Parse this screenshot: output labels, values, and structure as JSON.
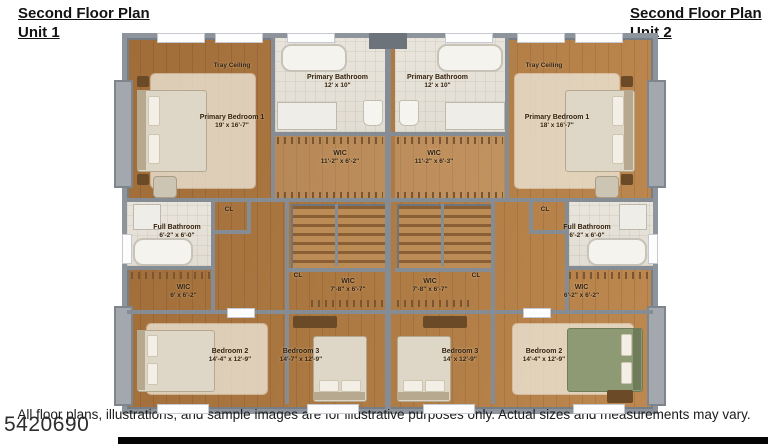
{
  "header": {
    "unit1": {
      "line1": "Second Floor Plan",
      "line2": "Unit 1"
    },
    "unit2": {
      "line1": "Second Floor Plan",
      "line2": "Unit 2"
    }
  },
  "plan": {
    "unit1": {
      "tray_ceiling": "Tray Ceiling",
      "primary_bedroom": {
        "name": "Primary Bedroom 1",
        "dims": "19' x 16'-7\""
      },
      "primary_bathroom": {
        "name": "Primary Bathroom",
        "dims": "12' x 10\""
      },
      "wic_upper": {
        "name": "WIC",
        "dims": "11'-2\" x 6'-2\""
      },
      "cl_upper": "CL",
      "full_bathroom": {
        "name": "Full Bathroom",
        "dims": "6'-2\" x 6'-0\""
      },
      "wic_side": {
        "name": "WIC",
        "dims": "6' x 6'-2\""
      },
      "cl_hall": "CL",
      "wic_hall": {
        "name": "WIC",
        "dims": "7'-8\" x 6'-7\""
      },
      "bedroom2": {
        "name": "Bedroom 2",
        "dims": "14'-4\" x 12'-9\""
      },
      "bedroom3": {
        "name": "Bedroom 3",
        "dims": "14'-7\" x 12'-9\""
      }
    },
    "unit2": {
      "tray_ceiling": "Tray Ceiling",
      "primary_bedroom": {
        "name": "Primary Bedroom 1",
        "dims": "18' x 16'-7\""
      },
      "primary_bathroom": {
        "name": "Primary Bathroom",
        "dims": "12' x 10\""
      },
      "wic_upper": {
        "name": "WIC",
        "dims": "11'-2\" x 6'-3\""
      },
      "cl_upper": "CL",
      "full_bathroom": {
        "name": "Full Bathroom",
        "dims": "6'-2\" x 6'-0\""
      },
      "wic_side": {
        "name": "WIC",
        "dims": "6'-2\" x 6'-2\""
      },
      "cl_hall": "CL",
      "wic_hall": {
        "name": "WIC",
        "dims": "7'-8\" x 6'-7\""
      },
      "bedroom2": {
        "name": "Bedroom 2",
        "dims": "14'-4\" x 12'-9\""
      },
      "bedroom3": {
        "name": "Bedroom 3",
        "dims": "14' x 12'-9\""
      }
    }
  },
  "footer": {
    "disclaimer": "All floor plans, illustrations, and sample images are for illustrative purposes only. Actual sizes and measurements may vary.",
    "listing_number": "5420690"
  },
  "colors": {
    "wood_floor": "#a9743f",
    "wall_gray": "#8e949c",
    "bath_tile": "#e8e4db",
    "green_bed": "#8d9a74",
    "bottom_bar": "#040404",
    "label_text": "#33220f"
  }
}
